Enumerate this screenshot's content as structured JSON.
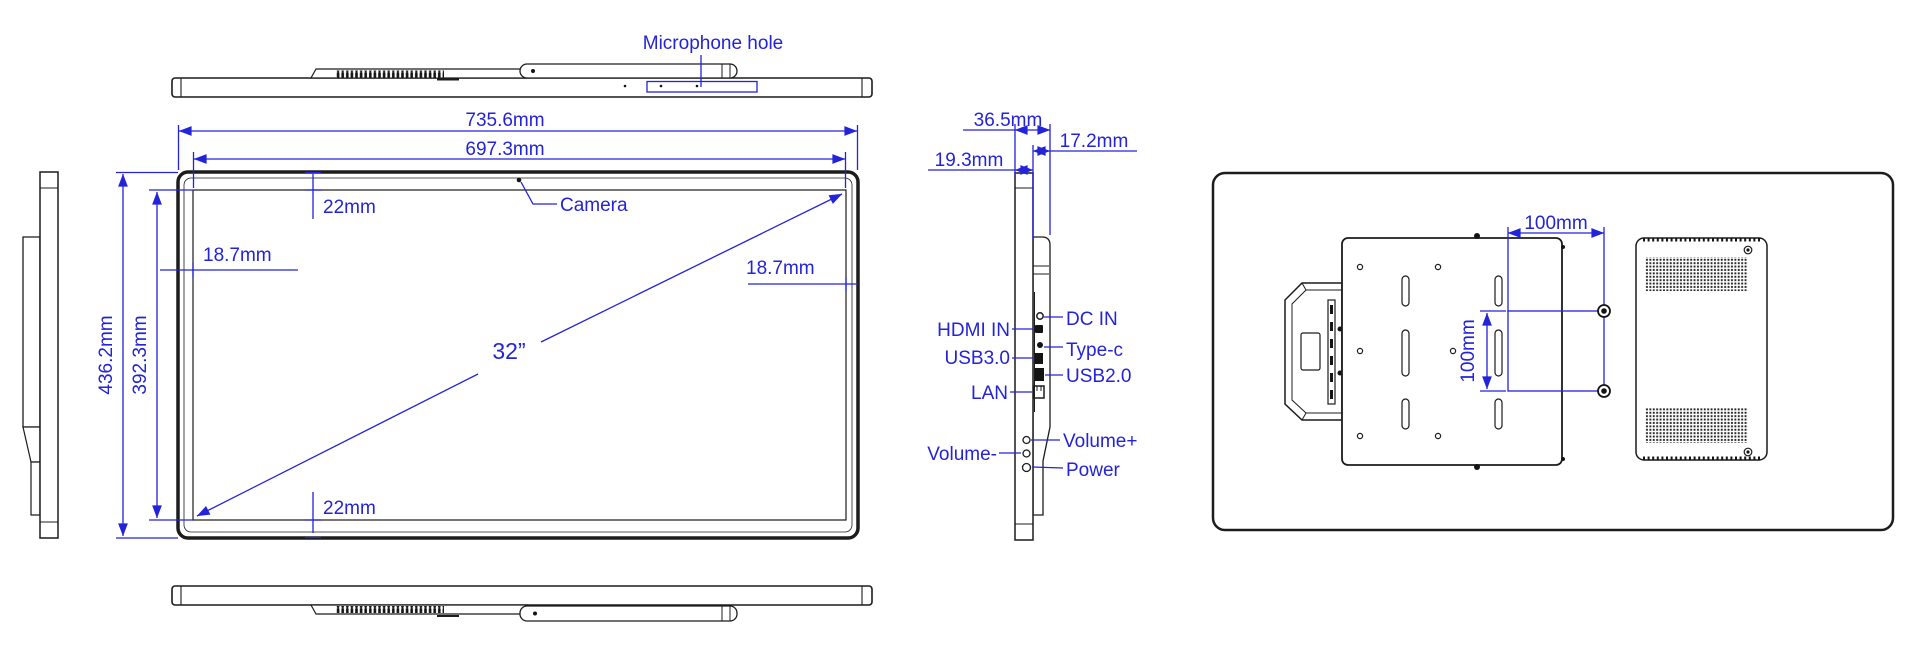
{
  "drawing": {
    "colors": {
      "annotation_blue": "#2323d9",
      "outline_black": "#1c1c1c"
    },
    "labels": {
      "microphone_hole": "Microphone hole",
      "camera": "Camera",
      "screen_size": "32”"
    },
    "front_dimensions": {
      "overall_width": "735.6mm",
      "active_width": "697.3mm",
      "overall_height": "436.2mm",
      "active_height": "392.3mm",
      "top_bezel": "22mm",
      "bottom_bezel": "22mm",
      "left_bezel": "18.7mm",
      "right_bezel": "18.7mm"
    },
    "side_dimensions": {
      "total_depth": "36.5mm",
      "back_depth": "17.2mm",
      "panel_depth": "19.3mm"
    },
    "side_ports": {
      "hdmi": "HDMI IN",
      "dc_in": "DC IN",
      "type_c": "Type-c",
      "usb3": "USB3.0",
      "usb2": "USB2.0",
      "lan": "LAN"
    },
    "side_buttons": {
      "volume_up": "Volume+",
      "volume_down": "Volume-",
      "power": "Power"
    },
    "back_dimensions": {
      "vesa_width": "100mm",
      "vesa_height": "100mm"
    }
  }
}
